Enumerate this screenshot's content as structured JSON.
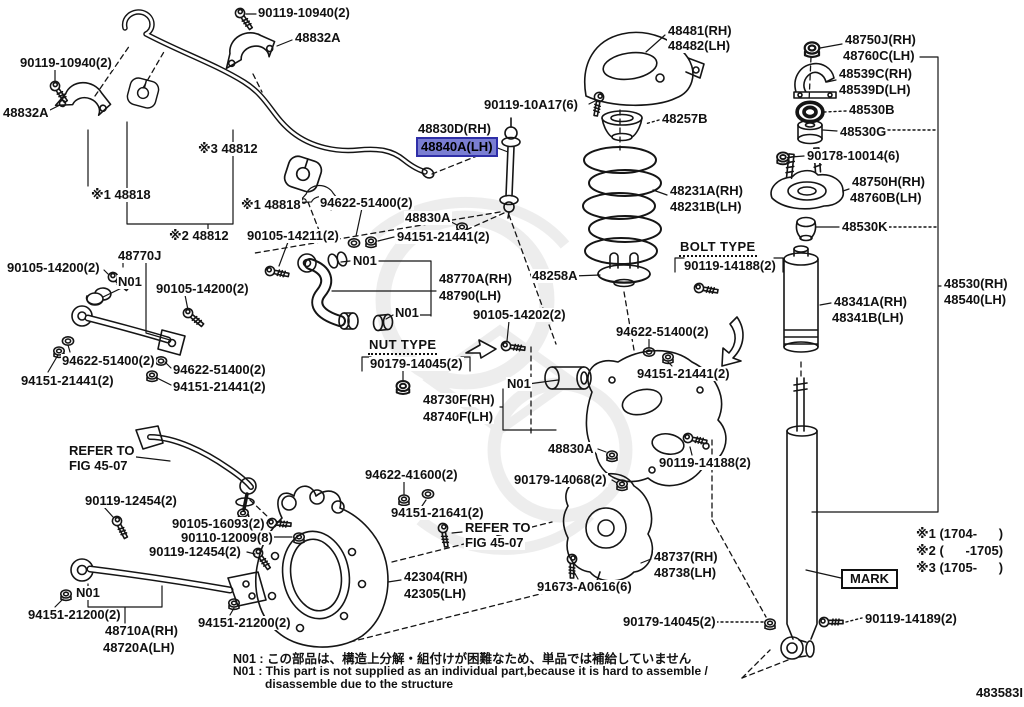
{
  "colors": {
    "line": "#151515",
    "background": "#ffffff",
    "highlight_fill": "#7a7ed2",
    "highlight_border": "#2f2fa8",
    "watermark": "#e0e0e0"
  },
  "highlighted_part": "48840A(LH)",
  "doc_number": "483583I",
  "notes": {
    "jp": "N01 : この部品は、構造上分解・組付けが困難なため、単品では補給していません",
    "en1": "N01 : This part is not supplied as an individual part,because it is hard to assemble /",
    "en2": "disassemble due to the structure"
  },
  "labels": [
    {
      "t": "90119-10940(2)",
      "x": 257,
      "y": 6,
      "k": "p"
    },
    {
      "t": "48832A",
      "x": 294,
      "y": 31,
      "k": "p"
    },
    {
      "t": "90119-10940(2)",
      "x": 19,
      "y": 56,
      "k": "p"
    },
    {
      "t": "48832A",
      "x": 2,
      "y": 106,
      "k": "p"
    },
    {
      "t": "※3 48812",
      "x": 197,
      "y": 142,
      "k": "p"
    },
    {
      "t": "※1 48818",
      "x": 90,
      "y": 188,
      "k": "p"
    },
    {
      "t": "※1 48818",
      "x": 240,
      "y": 198,
      "k": "p"
    },
    {
      "t": "※2 48812",
      "x": 168,
      "y": 229,
      "k": "p"
    },
    {
      "t": "48830D(RH)",
      "x": 417,
      "y": 122,
      "k": "p"
    },
    {
      "t": "48840A(LH)",
      "x": 418,
      "y": 139,
      "k": "p",
      "hl": 1,
      "n": "highlighted-part-label"
    },
    {
      "t": "90119-10A17(6)",
      "x": 483,
      "y": 98,
      "k": "p"
    },
    {
      "t": "48481(RH)",
      "x": 667,
      "y": 24,
      "k": "p"
    },
    {
      "t": "48482(LH)",
      "x": 667,
      "y": 39,
      "k": "p"
    },
    {
      "t": "48257B",
      "x": 661,
      "y": 112,
      "k": "p"
    },
    {
      "t": "48231A(RH)",
      "x": 669,
      "y": 184,
      "k": "p"
    },
    {
      "t": "48231B(LH)",
      "x": 669,
      "y": 200,
      "k": "p"
    },
    {
      "t": "BOLT TYPE",
      "x": 679,
      "y": 240,
      "k": "t"
    },
    {
      "t": "90119-14188(2)",
      "x": 683,
      "y": 259,
      "k": "p"
    },
    {
      "t": "48258A",
      "x": 531,
      "y": 269,
      "k": "p"
    },
    {
      "t": "94622-51400(2)",
      "x": 319,
      "y": 196,
      "k": "p"
    },
    {
      "t": "48830A",
      "x": 404,
      "y": 211,
      "k": "p"
    },
    {
      "t": "94151-21441(2)",
      "x": 396,
      "y": 230,
      "k": "p"
    },
    {
      "t": "90105-14211(2)",
      "x": 246,
      "y": 229,
      "k": "p"
    },
    {
      "t": "N01",
      "x": 352,
      "y": 254,
      "k": "n"
    },
    {
      "t": "48750J(RH)",
      "x": 844,
      "y": 33,
      "k": "p"
    },
    {
      "t": "48760C(LH)",
      "x": 842,
      "y": 49,
      "k": "p"
    },
    {
      "t": "48539C(RH)",
      "x": 838,
      "y": 67,
      "k": "p"
    },
    {
      "t": "48539D(LH)",
      "x": 838,
      "y": 83,
      "k": "p"
    },
    {
      "t": "48530B",
      "x": 848,
      "y": 103,
      "k": "p"
    },
    {
      "t": "48530G",
      "x": 839,
      "y": 125,
      "k": "p"
    },
    {
      "t": "90178-10014(6)",
      "x": 806,
      "y": 149,
      "k": "p"
    },
    {
      "t": "48750H(RH)",
      "x": 851,
      "y": 175,
      "k": "p"
    },
    {
      "t": "48760B(LH)",
      "x": 849,
      "y": 191,
      "k": "p"
    },
    {
      "t": "48530K",
      "x": 841,
      "y": 220,
      "k": "p"
    },
    {
      "t": "48341A(RH)",
      "x": 833,
      "y": 295,
      "k": "p"
    },
    {
      "t": "48341B(LH)",
      "x": 831,
      "y": 311,
      "k": "p"
    },
    {
      "t": "48530(RH)",
      "x": 943,
      "y": 277,
      "k": "p"
    },
    {
      "t": "48540(LH)",
      "x": 943,
      "y": 293,
      "k": "p"
    },
    {
      "t": "48770J",
      "x": 117,
      "y": 249,
      "k": "p"
    },
    {
      "t": "90105-14200(2)",
      "x": 6,
      "y": 261,
      "k": "p"
    },
    {
      "t": "N01",
      "x": 117,
      "y": 275,
      "k": "n"
    },
    {
      "t": "90105-14200(2)",
      "x": 155,
      "y": 282,
      "k": "p"
    },
    {
      "t": "94622-51400(2)",
      "x": 61,
      "y": 354,
      "k": "p"
    },
    {
      "t": "94151-21441(2)",
      "x": 20,
      "y": 374,
      "k": "p"
    },
    {
      "t": "94622-51400(2)",
      "x": 172,
      "y": 363,
      "k": "p"
    },
    {
      "t": "94151-21441(2)",
      "x": 172,
      "y": 380,
      "k": "p"
    },
    {
      "t": "48770A(RH)",
      "x": 438,
      "y": 272,
      "k": "p"
    },
    {
      "t": "48790(LH)",
      "x": 438,
      "y": 289,
      "k": "p"
    },
    {
      "t": "N01",
      "x": 394,
      "y": 306,
      "k": "n"
    },
    {
      "t": "90105-14202(2)",
      "x": 472,
      "y": 308,
      "k": "p"
    },
    {
      "t": "NUT TYPE",
      "x": 368,
      "y": 338,
      "k": "t"
    },
    {
      "t": "90179-14045(2)",
      "x": 369,
      "y": 357,
      "k": "p"
    },
    {
      "t": "94622-51400(2)",
      "x": 615,
      "y": 325,
      "k": "p"
    },
    {
      "t": "94151-21441(2)",
      "x": 636,
      "y": 367,
      "k": "p"
    },
    {
      "t": "N01",
      "x": 506,
      "y": 377,
      "k": "n"
    },
    {
      "t": "48730F(RH)",
      "x": 422,
      "y": 393,
      "k": "p"
    },
    {
      "t": "48740F(LH)",
      "x": 422,
      "y": 410,
      "k": "p"
    },
    {
      "t": "48830A",
      "x": 547,
      "y": 442,
      "k": "p"
    },
    {
      "t": "90179-14068(2)",
      "x": 513,
      "y": 473,
      "k": "p"
    },
    {
      "t": "90119-14188(2)",
      "x": 658,
      "y": 456,
      "k": "p"
    },
    {
      "t": "REFER TO",
      "x": 68,
      "y": 444,
      "k": "r",
      "n": "refer-to-fig-label"
    },
    {
      "t": "FIG 45-07",
      "x": 68,
      "y": 459,
      "k": "r",
      "n": "refer-to-fig-label"
    },
    {
      "t": "90119-12454(2)",
      "x": 84,
      "y": 494,
      "k": "p"
    },
    {
      "t": "90105-16093(2)",
      "x": 171,
      "y": 517,
      "k": "p"
    },
    {
      "t": "90110-12009(8)",
      "x": 180,
      "y": 531,
      "k": "p"
    },
    {
      "t": "90119-12454(2)",
      "x": 148,
      "y": 545,
      "k": "p"
    },
    {
      "t": "94622-41600(2)",
      "x": 364,
      "y": 468,
      "k": "p"
    },
    {
      "t": "94151-21641(2)",
      "x": 390,
      "y": 506,
      "k": "p"
    },
    {
      "t": "REFER TO",
      "x": 464,
      "y": 521,
      "k": "r",
      "n": "refer-to-fig-label"
    },
    {
      "t": "FIG 45-07",
      "x": 464,
      "y": 536,
      "k": "r",
      "n": "refer-to-fig-label"
    },
    {
      "t": "42304(RH)",
      "x": 403,
      "y": 570,
      "k": "p"
    },
    {
      "t": "42305(LH)",
      "x": 403,
      "y": 587,
      "k": "p"
    },
    {
      "t": "91673-A0616(6)",
      "x": 536,
      "y": 580,
      "k": "p"
    },
    {
      "t": "48737(RH)",
      "x": 653,
      "y": 550,
      "k": "p"
    },
    {
      "t": "48738(LH)",
      "x": 653,
      "y": 566,
      "k": "p"
    },
    {
      "t": "90179-14045(2)",
      "x": 622,
      "y": 615,
      "k": "p"
    },
    {
      "t": "N01",
      "x": 75,
      "y": 586,
      "k": "n"
    },
    {
      "t": "94151-21200(2)",
      "x": 27,
      "y": 608,
      "k": "p"
    },
    {
      "t": "48710A(RH)",
      "x": 104,
      "y": 624,
      "k": "p"
    },
    {
      "t": "48720A(LH)",
      "x": 102,
      "y": 641,
      "k": "p"
    },
    {
      "t": "94151-21200(2)",
      "x": 197,
      "y": 616,
      "k": "p"
    },
    {
      "t": "MARK",
      "x": 841,
      "y": 569,
      "k": "m",
      "n": "mark-box-label"
    },
    {
      "t": "90119-14189(2)",
      "x": 864,
      "y": 612,
      "k": "p"
    },
    {
      "t": "※1 (1704-      )",
      "x": 915,
      "y": 527,
      "k": "l",
      "n": "legend-line-1"
    },
    {
      "t": "※2 (      -1705)",
      "x": 915,
      "y": 544,
      "k": "l",
      "n": "legend-line-2"
    },
    {
      "t": "※3 (1705-      )",
      "x": 915,
      "y": 561,
      "k": "l",
      "n": "legend-line-3"
    }
  ]
}
